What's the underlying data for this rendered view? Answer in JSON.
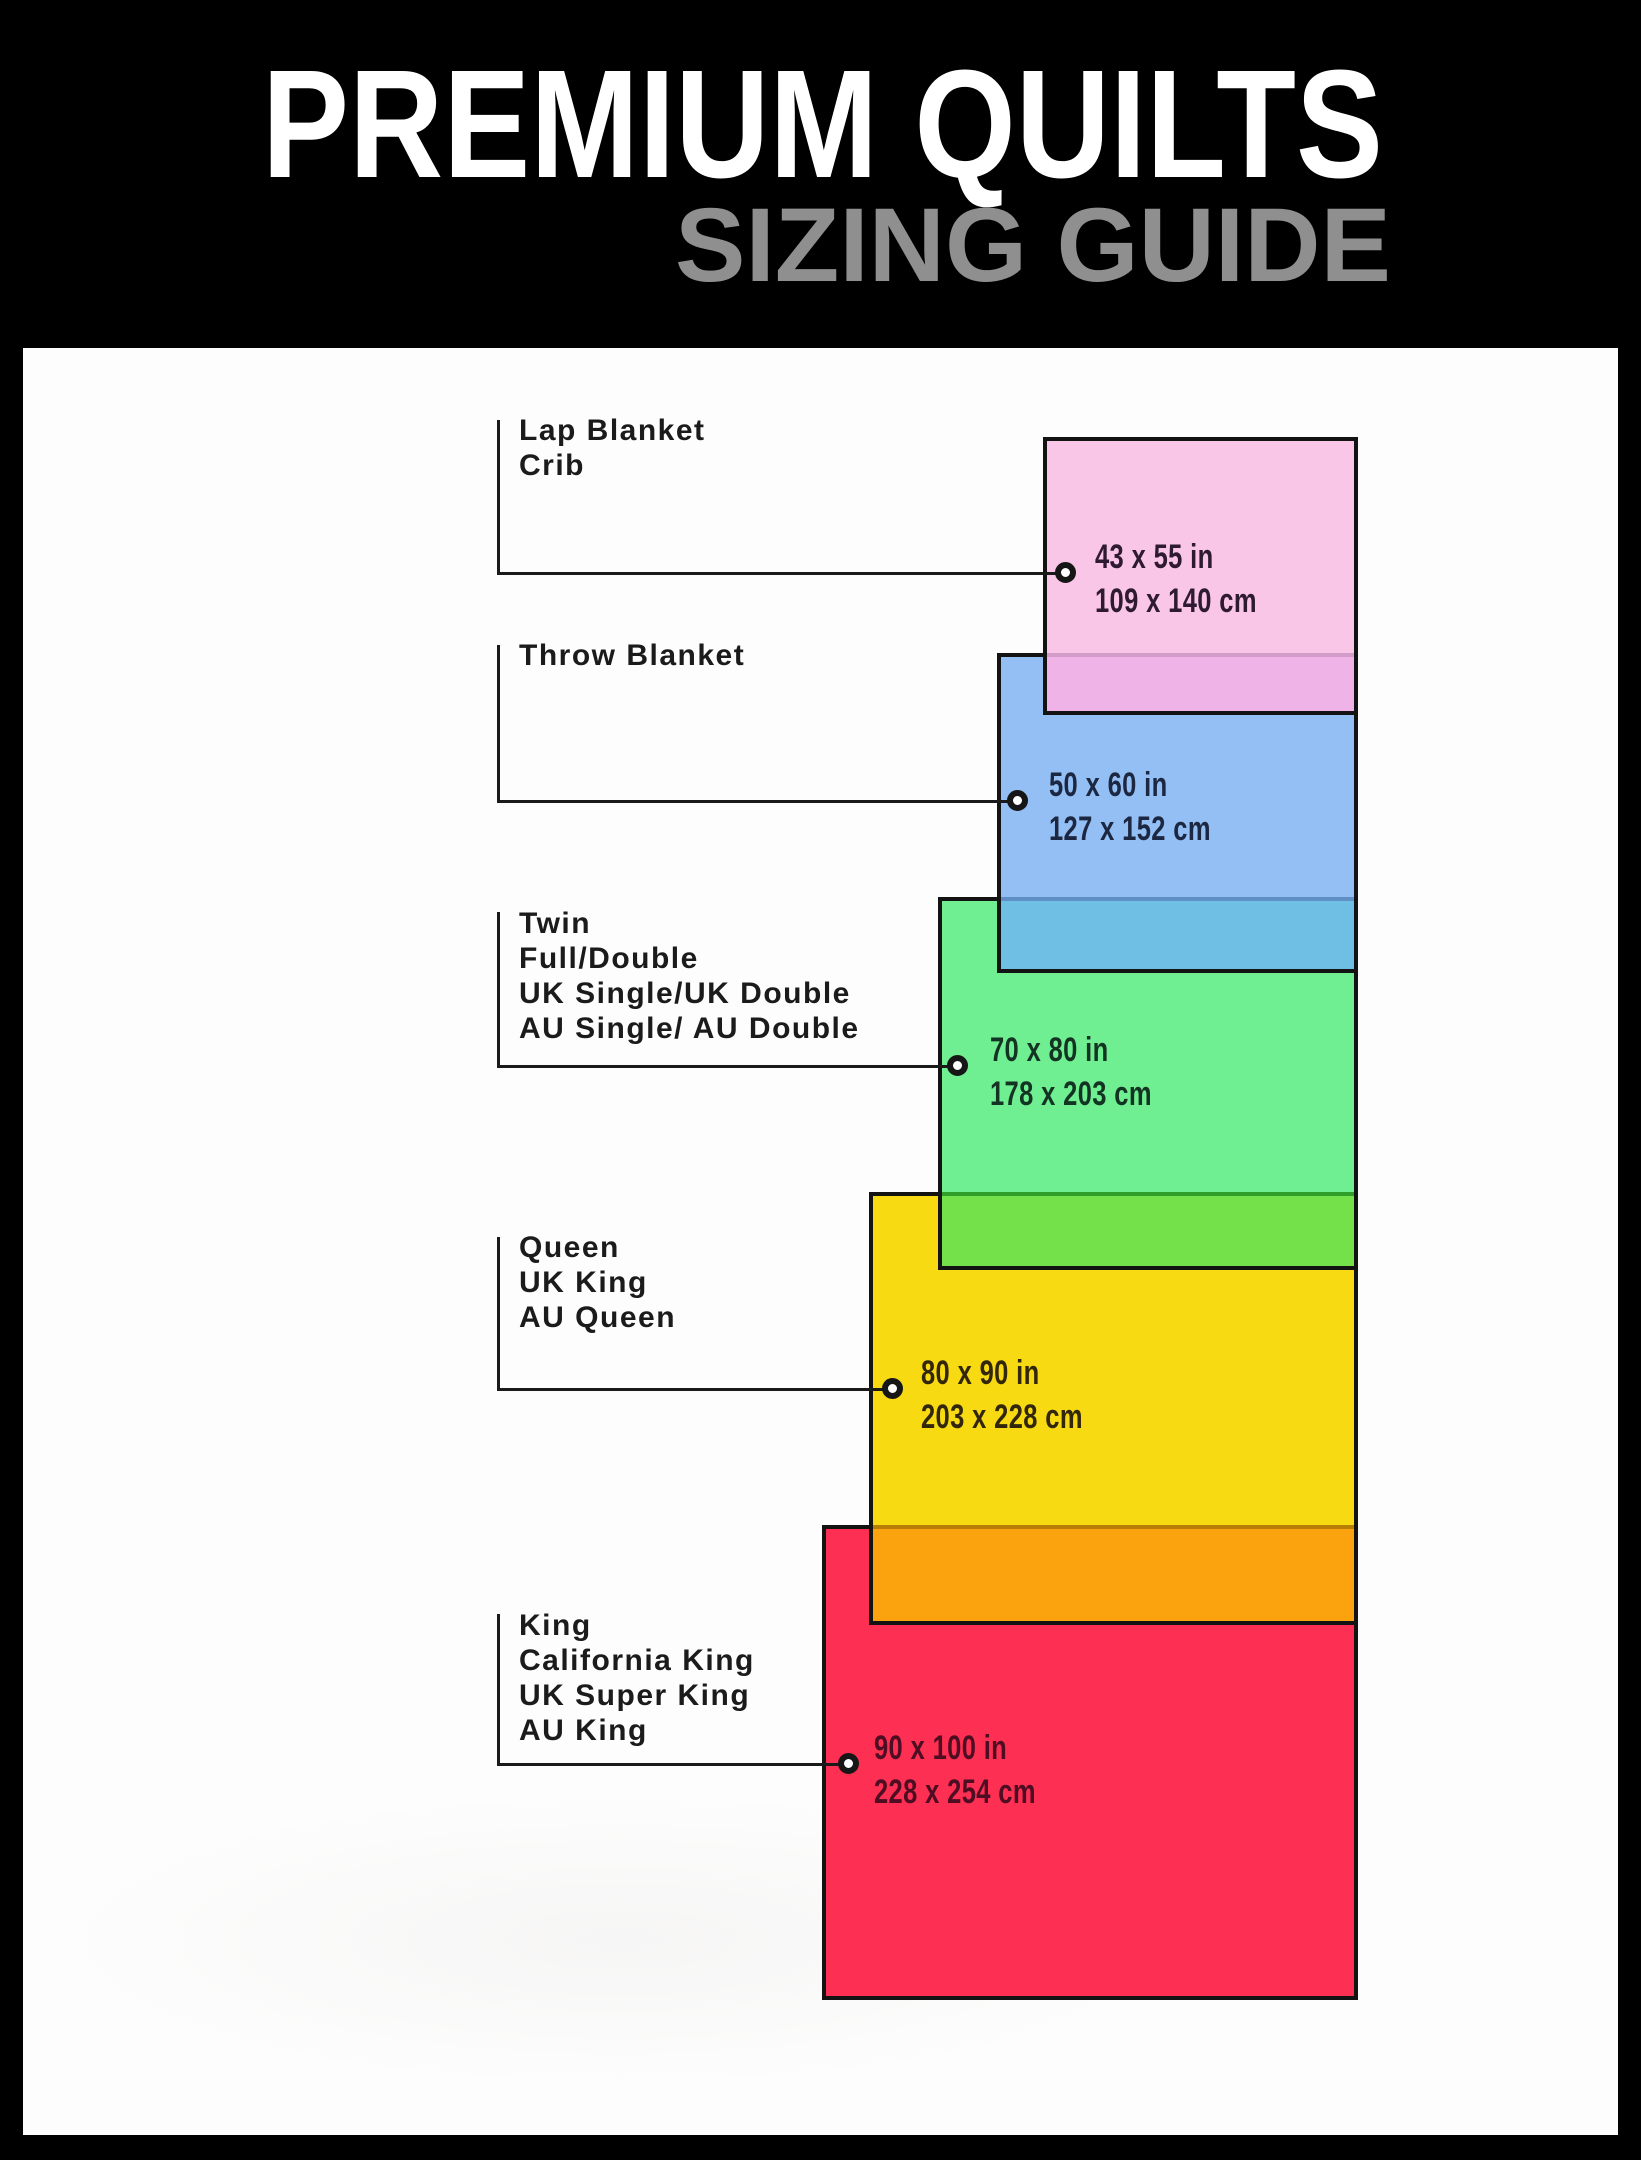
{
  "header": {
    "title": "PREMIUM QUILTS",
    "subtitle": "SIZING GUIDE",
    "background": "#000000",
    "title_color": "#ffffff",
    "subtitle_color": "#8f8f8f"
  },
  "canvas": {
    "background": "#fdfdfd",
    "frame_color": "#000000",
    "rect_border_color": "#131313",
    "connector_color": "#1a1a1a"
  },
  "quilts": [
    {
      "id": "lap-blanket-crib",
      "labels": [
        "Lap Blanket",
        "Crib"
      ],
      "size_in": "43 x 55 in",
      "size_cm": "109 x 140 cm",
      "colors": {
        "fill": "#f9c6e7",
        "overlap": "#efb3e8",
        "separator": "#d49cc9",
        "text": "#2e1a33"
      }
    },
    {
      "id": "throw-blanket",
      "labels": [
        "Throw Blanket"
      ],
      "size_in": "50 x 60 in",
      "size_cm": "127 x 152 cm",
      "colors": {
        "fill": "#94bff4",
        "overlap": "#6fbfe5",
        "separator": "#5f8fc4",
        "text": "#1c2742"
      }
    },
    {
      "id": "twin-full-double",
      "labels": [
        "Twin",
        "Full/Double",
        "UK Single/UK Double",
        "AU Single/ AU Double"
      ],
      "size_in": "70 x 80 in",
      "size_cm": "178 x 203 cm",
      "colors": {
        "fill": "#70ee92",
        "overlap": "#74e14b",
        "separator": "#2f9e2a",
        "text": "#143423"
      }
    },
    {
      "id": "queen",
      "labels": [
        "Queen",
        "UK King",
        "AU Queen"
      ],
      "size_in": "80 x 90 in",
      "size_cm": "203 x 228 cm",
      "colors": {
        "fill": "#f8da12",
        "overlap": "#fba30f",
        "separator": "#b87d05",
        "text": "#33270b"
      }
    },
    {
      "id": "king-cal-king",
      "labels": [
        "King",
        "California King",
        "UK Super King",
        "AU King"
      ],
      "size_in": "90 x 100 in",
      "size_cm": "228 x 254 cm",
      "colors": {
        "fill": "#fd2f52",
        "overlap": null,
        "separator": null,
        "text": "#4d0d22"
      }
    }
  ]
}
